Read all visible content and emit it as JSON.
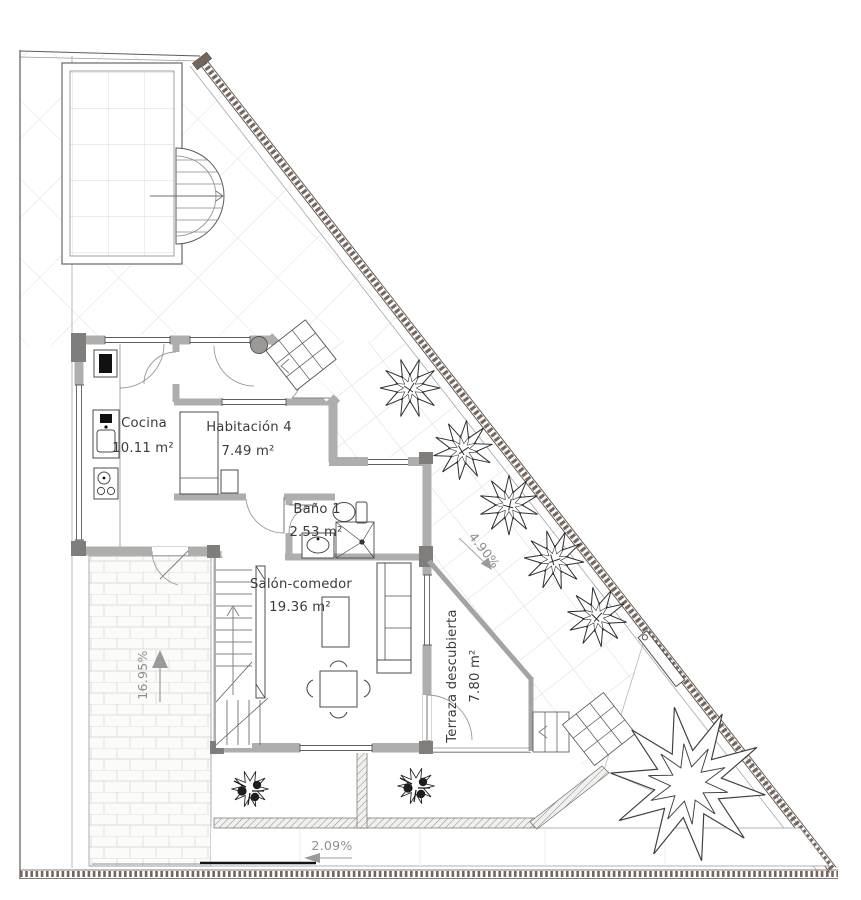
{
  "plan": {
    "rooms": {
      "cocina": {
        "name": "Cocina",
        "area": "10.11 m²"
      },
      "habitacion4": {
        "name": "Habitación 4",
        "area": "7.49 m²"
      },
      "bano1": {
        "name": "Baño 1",
        "area": "2.53 m²"
      },
      "salon": {
        "name": "Salón-comedor",
        "area": "19.36 m²"
      },
      "terraza": {
        "name": "Terraza descubierta",
        "area": "7.80 m²"
      }
    },
    "slopes": {
      "ramp": "16.95%",
      "garden": "4.90%",
      "walkway": "2.09%"
    },
    "colors": {
      "wall": "#afaead",
      "wall_dark": "#7f7e7c",
      "fence": "#75655b",
      "grid": "#dbd9d7",
      "crosshatch": "#e3e1df",
      "slope_text": "#8f8f8f",
      "label_text": "#3b3b3b",
      "plant_dark": "#1e1e1e"
    }
  }
}
